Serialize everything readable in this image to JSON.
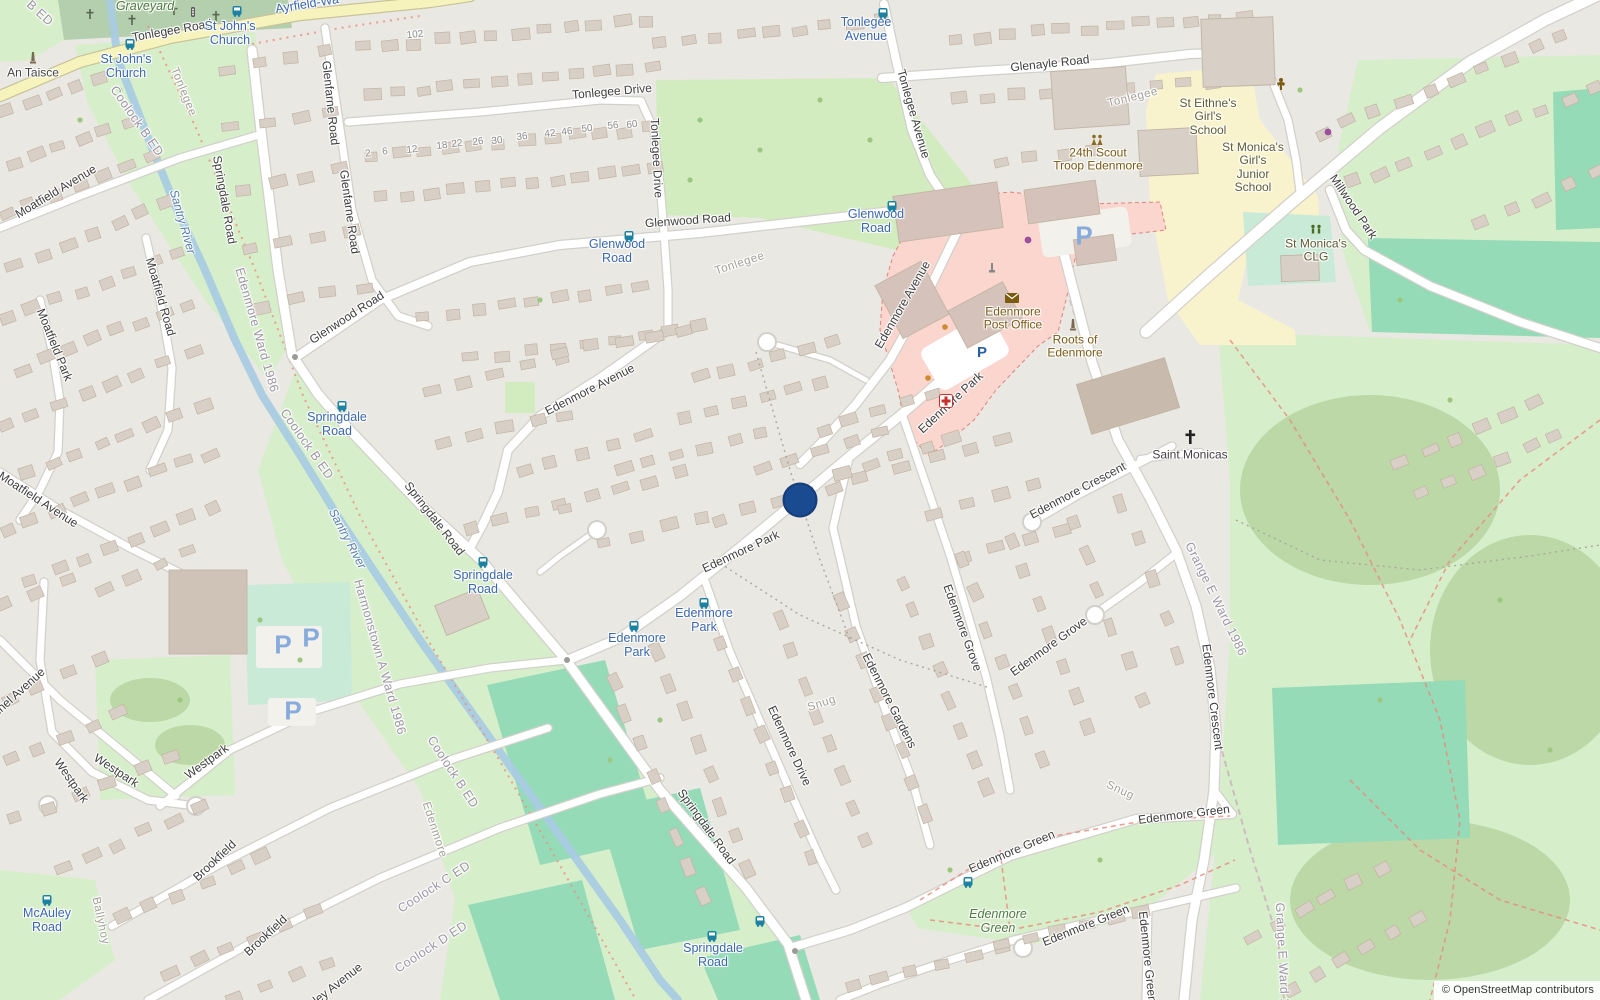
{
  "map": {
    "attribution": "© OpenStreetMap contributors",
    "marker": {
      "x": 800,
      "y": 500,
      "d": 35,
      "color": "#1a4a8f"
    },
    "colors": {
      "marker_blue": "#1a4a8f",
      "bus_label_blue": "#3a67ad",
      "road_label": "#3e3e3e",
      "primary_road_yellow": "#f6f3bd",
      "park_green": "#d7eecb",
      "pitch_teal": "#95dbb8",
      "retail_pink": "#fbd6cf",
      "school_yellow": "#f9f3cd",
      "water_blue": "#a9cbe2",
      "building": "#d8cfc6"
    },
    "labels": [
      [
        "Tonlegee Road",
        172,
        31,
        -10,
        "road"
      ],
      [
        "Tonlegee Drive",
        612,
        92,
        -5,
        "road"
      ],
      [
        "Tonlegee Drive",
        656,
        158,
        87,
        "road"
      ],
      [
        "Glenayle Road",
        1050,
        64,
        -6,
        "road"
      ],
      [
        "Glenfarne Road",
        330,
        103,
        84,
        "road"
      ],
      [
        "Glenfarne Road",
        349,
        212,
        82,
        "road"
      ],
      [
        "Glenwood Road",
        347,
        318,
        -33,
        "road"
      ],
      [
        "Glenwood Road",
        688,
        221,
        -4,
        "road"
      ],
      [
        "Springdale Road",
        224,
        200,
        80,
        "road"
      ],
      [
        "Springdale Road",
        434,
        519,
        52,
        "road"
      ],
      [
        "Springdale Road",
        706,
        827,
        54,
        "road"
      ],
      [
        "Tonlegee Avenue",
        913,
        114,
        74,
        "road"
      ],
      [
        "Edenmore Avenue",
        590,
        390,
        -27,
        "road"
      ],
      [
        "Edenmore Avenue",
        903,
        305,
        -60,
        "road"
      ],
      [
        "Edenmore Park",
        951,
        403,
        -43,
        "road"
      ],
      [
        "Edenmore Park",
        741,
        552,
        -25,
        "road"
      ],
      [
        "Edenmore Drive",
        789,
        746,
        65,
        "road"
      ],
      [
        "Edenmore Gardens",
        889,
        701,
        63,
        "road"
      ],
      [
        "Edenmore Grove",
        962,
        628,
        70,
        "road"
      ],
      [
        "Edenmore Grove",
        1049,
        647,
        -36,
        "road"
      ],
      [
        "Edenmore Crescent",
        1078,
        491,
        -28,
        "road"
      ],
      [
        "Edenmore Crescent",
        1212,
        697,
        83,
        "road"
      ],
      [
        "Edenmore Green",
        1184,
        815,
        -7,
        "road"
      ],
      [
        "Edenmore Green",
        1012,
        852,
        -23,
        "road"
      ],
      [
        "Edenmore Green",
        1086,
        926,
        -22,
        "road"
      ],
      [
        "Edenmore Green",
        1147,
        957,
        84,
        "road"
      ],
      [
        "Millwood Park",
        1353,
        207,
        56,
        "road"
      ],
      [
        "Moatfield Avenue",
        56,
        192,
        -31,
        "road"
      ],
      [
        "Moatfield Avenue",
        38,
        500,
        33,
        "road"
      ],
      [
        "Moatfield Road",
        160,
        297,
        74,
        "road"
      ],
      [
        "Moatfield Park",
        54,
        345,
        68,
        "road"
      ],
      [
        "Westpark",
        71,
        781,
        55,
        "road"
      ],
      [
        "Westpark",
        116,
        771,
        33,
        "road"
      ],
      [
        "Westpark",
        207,
        762,
        -36,
        "road"
      ],
      [
        "Brookfield",
        215,
        861,
        -43,
        "road"
      ],
      [
        "Brookfield",
        266,
        936,
        -43,
        "road"
      ],
      [
        "Lennel Avenue",
        14,
        697,
        -42,
        "road"
      ],
      [
        "ley Avenue",
        338,
        984,
        -38,
        "road"
      ],
      [
        "102",
        415,
        35,
        -6,
        "hn"
      ],
      [
        "2",
        368,
        154,
        -6,
        "hn"
      ],
      [
        "6",
        385,
        152,
        -6,
        "hn"
      ],
      [
        "12",
        412,
        150,
        -6,
        "hn"
      ],
      [
        "18",
        442,
        146,
        -6,
        "hn"
      ],
      [
        "22",
        457,
        144,
        -6,
        "hn"
      ],
      [
        "26",
        478,
        142,
        -6,
        "hn"
      ],
      [
        "30",
        497,
        141,
        -6,
        "hn"
      ],
      [
        "36",
        522,
        137,
        -6,
        "hn"
      ],
      [
        "42",
        550,
        134,
        -6,
        "hn"
      ],
      [
        "46",
        567,
        132,
        -6,
        "hn"
      ],
      [
        "50",
        587,
        129,
        -6,
        "hn"
      ],
      [
        "56",
        613,
        126,
        -6,
        "hn"
      ],
      [
        "60",
        632,
        125,
        -6,
        "hn"
      ],
      [
        "Tonlegee",
        183,
        92,
        68,
        "tl"
      ],
      [
        "Tonlegee",
        740,
        264,
        -18,
        "tl"
      ],
      [
        "Tonlegee",
        1133,
        98,
        -14,
        "tl"
      ],
      [
        "Edenmore",
        434,
        830,
        72,
        "tl"
      ],
      [
        "Ballyhoy",
        100,
        921,
        78,
        "tl"
      ],
      [
        "Snug",
        822,
        704,
        -18,
        "tl"
      ],
      [
        "Snug",
        1120,
        791,
        25,
        "tl"
      ],
      [
        "Santry River",
        182,
        222,
        74,
        "water"
      ],
      [
        "Santry River",
        347,
        539,
        62,
        "water"
      ],
      [
        "Coolock B ED",
        137,
        121,
        55,
        "bd"
      ],
      [
        "Coolock B ED",
        307,
        444,
        55,
        "bd"
      ],
      [
        "Coolock B ED",
        453,
        772,
        57,
        "bd"
      ],
      [
        "Coolock C ED",
        434,
        887,
        -33,
        "bd"
      ],
      [
        "Coolock D ED",
        431,
        947,
        -33,
        "bd"
      ],
      [
        "B ED",
        40,
        13,
        42,
        "bd"
      ],
      [
        "Harmonstown A Ward 1986",
        380,
        657,
        74,
        "bd"
      ],
      [
        "Edenmore Ward 1986",
        257,
        330,
        74,
        "bd"
      ],
      [
        "Grange E Ward 1986",
        1216,
        599,
        64,
        "bd"
      ],
      [
        "Grange E Ward 1986",
        1283,
        965,
        87,
        "bd"
      ],
      [
        "Graveyard",
        145,
        6,
        0,
        "park"
      ],
      [
        "Edenmore\nGreen",
        998,
        921,
        0,
        "park"
      ],
      [
        "St John's\nChurch",
        230,
        33,
        0,
        "bus"
      ],
      [
        "St John's\nChurch",
        126,
        66,
        0,
        "bus"
      ],
      [
        "Ayrfield-Wa",
        307,
        4,
        -9,
        "bus"
      ],
      [
        "Tonlegee\nAvenue",
        866,
        29,
        0,
        "bus"
      ],
      [
        "Glenwood\nRoad",
        876,
        221,
        0,
        "bus"
      ],
      [
        "Glenwood\nRoad",
        617,
        251,
        0,
        "bus"
      ],
      [
        "Springdale\nRoad",
        337,
        424,
        0,
        "bus"
      ],
      [
        "Springdale\nRoad",
        483,
        582,
        0,
        "bus"
      ],
      [
        "Springdale\nRoad",
        713,
        955,
        0,
        "bus"
      ],
      [
        "Edenmore\nPark",
        637,
        645,
        0,
        "bus"
      ],
      [
        "Edenmore\nPark",
        704,
        620,
        0,
        "bus"
      ],
      [
        "McAuley\nRoad",
        47,
        920,
        0,
        "bus"
      ],
      [
        "An Taisce",
        33,
        73,
        0,
        "poi"
      ],
      [
        "Edenmore\nPost Office",
        1013,
        319,
        0,
        "amen"
      ],
      [
        "Roots of\nEdenmore",
        1075,
        347,
        0,
        "amen"
      ],
      [
        "24th Scout\nTroop Edenmore",
        1098,
        160,
        0,
        "amen"
      ],
      [
        "St Eithne's\nGirl's\nSchool",
        1208,
        117,
        0,
        "school"
      ],
      [
        "St Monica's\nGirl's\nJunior\nSchool",
        1253,
        168,
        0,
        "school"
      ],
      [
        "St Monica's\nCLG",
        1316,
        251,
        0,
        "school"
      ],
      [
        "Saint Monicas",
        1190,
        455,
        0,
        "church"
      ]
    ],
    "icons": [
      [
        "bus-stop",
        237,
        11
      ],
      [
        "bus-stop",
        130,
        44
      ],
      [
        "bus-stop",
        883,
        13
      ],
      [
        "bus-stop",
        892,
        206
      ],
      [
        "bus-stop",
        629,
        236
      ],
      [
        "bus-stop",
        342,
        406
      ],
      [
        "bus-stop",
        483,
        562
      ],
      [
        "bus-stop",
        634,
        626
      ],
      [
        "bus-stop",
        704,
        603
      ],
      [
        "bus-stop",
        712,
        936
      ],
      [
        "bus-stop",
        760,
        921
      ],
      [
        "bus-stop",
        968,
        882
      ],
      [
        "bus-stop",
        47,
        900
      ],
      [
        "parking",
        982,
        353
      ],
      [
        "parking-lot",
        1084,
        238
      ],
      [
        "parking-lot",
        283,
        647
      ],
      [
        "parking-lot",
        311,
        640
      ],
      [
        "parking-lot",
        293,
        713
      ],
      [
        "pharmacy",
        946,
        401
      ],
      [
        "post-office",
        1012,
        298
      ],
      [
        "monument",
        1073,
        325
      ],
      [
        "monument",
        33,
        58
      ],
      [
        "traffic-signal",
        193,
        13
      ],
      [
        "scout-group",
        1097,
        140
      ],
      [
        "community-centre",
        1281,
        84
      ],
      [
        "sports-pitch",
        1316,
        230
      ],
      [
        "christian-cross",
        1190,
        437
      ],
      [
        "artwork",
        992,
        268
      ],
      [
        "dot-purple",
        1028,
        240
      ],
      [
        "dot-purple",
        1328,
        132
      ],
      [
        "dot-orange",
        945,
        327
      ],
      [
        "dot-orange",
        928,
        378
      ]
    ]
  }
}
